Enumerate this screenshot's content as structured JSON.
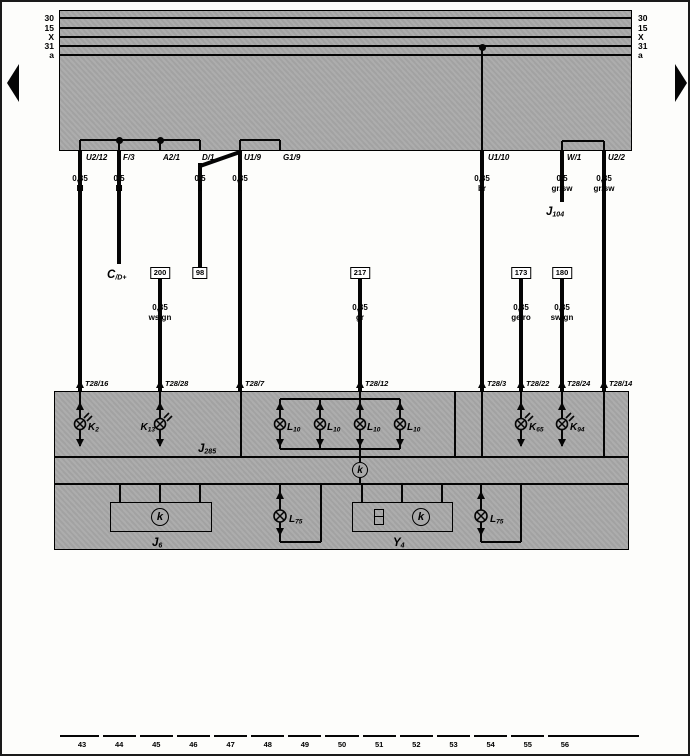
{
  "colors": {
    "band_gray": "#a9a9a9",
    "ink": "#050505",
    "paper": "#fdfdfb"
  },
  "bus": {
    "labels": [
      "30",
      "15",
      "X",
      "31",
      "a"
    ],
    "line_ys": [
      16,
      26,
      35,
      44,
      53
    ],
    "band": {
      "x": 57,
      "y": 8,
      "w": 573,
      "h": 141
    },
    "tap": {
      "x": 480,
      "y": 45
    }
  },
  "pins": {
    "label_y": 151,
    "items": [
      {
        "label": "U2/12",
        "x": 84
      },
      {
        "label": "F/3",
        "x": 121
      },
      {
        "label": "A2/1",
        "x": 161
      },
      {
        "label": "D/1",
        "x": 200
      },
      {
        "label": "U1/9",
        "x": 242
      },
      {
        "label": "G1/9",
        "x": 281
      },
      {
        "label": "U1/10",
        "x": 486
      },
      {
        "label": "W/1",
        "x": 565
      },
      {
        "label": "U2/2",
        "x": 606
      }
    ]
  },
  "brackets": [
    {
      "x1": 78,
      "x2": 198,
      "y": 138,
      "dots": [
        117,
        158
      ]
    },
    {
      "x1": 238,
      "x2": 278,
      "y": 138,
      "dots": []
    },
    {
      "x1": 560,
      "x2": 602,
      "y": 139,
      "dots": []
    }
  ],
  "wires": [
    {
      "x": 78,
      "y1": 149,
      "y2": 389
    },
    {
      "x": 117,
      "y1": 149,
      "y2": 262
    },
    {
      "x": 198,
      "y1": 161,
      "y2": 266
    },
    {
      "x": 158,
      "y1": 276,
      "y2": 389
    },
    {
      "x": 238,
      "y1": 149,
      "y2": 389
    },
    {
      "x": 358,
      "y1": 276,
      "y2": 389
    },
    {
      "x": 480,
      "y1": 149,
      "y2": 389
    },
    {
      "x": 519,
      "y1": 276,
      "y2": 389
    },
    {
      "x": 560,
      "y1": 149,
      "y2": 200
    },
    {
      "x": 560,
      "y1": 276,
      "y2": 389
    },
    {
      "x": 602,
      "y1": 149,
      "y2": 389
    }
  ],
  "diagonal": {
    "x": 198,
    "y": 164,
    "len": 43,
    "angle": -19.3
  },
  "specs": [
    {
      "size": "0,35",
      "color": "bl",
      "x": 78,
      "y": 172
    },
    {
      "size": "0,5",
      "color": "bl",
      "x": 117,
      "y": 172
    },
    {
      "size": "0,5",
      "color": "li",
      "x": 198,
      "y": 172
    },
    {
      "size": "0,35",
      "color": "li",
      "x": 238,
      "y": 172
    },
    {
      "size": "0,35",
      "color": "br",
      "x": 480,
      "y": 172
    },
    {
      "size": "0,5",
      "color": "gr/sw",
      "x": 560,
      "y": 172
    },
    {
      "size": "0,35",
      "color": "gr/sw",
      "x": 602,
      "y": 172
    },
    {
      "size": "0,35",
      "color": "ws/gn",
      "x": 158,
      "y": 301
    },
    {
      "size": "0,35",
      "color": "gr",
      "x": 358,
      "y": 301
    },
    {
      "size": "0,35",
      "color": "ge/ro",
      "x": 519,
      "y": 301
    },
    {
      "size": "0,35",
      "color": "sw/gn",
      "x": 560,
      "y": 301
    }
  ],
  "ref_boxes": {
    "y": 265,
    "items": [
      {
        "label": "200",
        "x": 158
      },
      {
        "label": "98",
        "x": 198
      },
      {
        "label": "217",
        "x": 358
      },
      {
        "label": "173",
        "x": 519
      },
      {
        "label": "180",
        "x": 560
      }
    ]
  },
  "inline_refs": [
    {
      "main": "C",
      "sub": "/D+",
      "x": 105,
      "y": 263
    },
    {
      "main": "J",
      "sub": "104",
      "x": 544,
      "y": 200
    }
  ],
  "terminals": {
    "arrow_y": 378,
    "label_y": 377,
    "items": [
      {
        "label": "T28/16",
        "x": 78
      },
      {
        "label": "T28/28",
        "x": 158
      },
      {
        "label": "T28/7",
        "x": 238
      },
      {
        "label": "T28/12",
        "x": 358
      },
      {
        "label": "T28/3",
        "x": 480
      },
      {
        "label": "T28/22",
        "x": 519
      },
      {
        "label": "T28/24",
        "x": 560
      },
      {
        "label": "T28/14",
        "x": 602
      }
    ]
  },
  "cluster": {
    "rect": {
      "x": 52,
      "y": 389,
      "w": 575,
      "h": 159
    },
    "h_dividers": [
      455,
      482
    ],
    "section_dividers": [
      239,
      453
    ],
    "through_wires": [
      480,
      602
    ],
    "label": {
      "main": "J",
      "sub": "285",
      "x": 196,
      "y": 437
    },
    "k_lamps": [
      {
        "main": "K",
        "sub": "2",
        "x": 78,
        "side": "right"
      },
      {
        "main": "K",
        "sub": "13",
        "x": 158,
        "side": "left"
      },
      {
        "main": "K",
        "sub": "65",
        "x": 519,
        "side": "right"
      },
      {
        "main": "K",
        "sub": "94",
        "x": 560,
        "side": "right"
      }
    ],
    "l10": {
      "main": "L",
      "sub": "10",
      "xs": [
        278,
        318,
        358,
        398
      ],
      "bus_top": 397,
      "bus_bottom": 447,
      "feed_x": 358
    },
    "k_connector": {
      "letter": "k",
      "x": 358,
      "y": 468
    }
  },
  "lower": {
    "box_y": 500,
    "box_h": 30,
    "label_y": 531,
    "boxes": [
      {
        "main": "J",
        "sub": "6",
        "x": 108,
        "w": 102,
        "stubs": [
          118,
          158,
          198
        ],
        "k_x": 158,
        "label_x": 150
      },
      {
        "main": "Y",
        "sub": "4",
        "x": 350,
        "w": 101,
        "stubs": [
          360,
          400,
          440
        ],
        "k_x": 419,
        "clock_x": 372,
        "label_x": 391
      }
    ],
    "lamps": [
      {
        "main": "L",
        "sub": "75",
        "x": 278,
        "loop": 41
      },
      {
        "main": "L",
        "sub": "75",
        "x": 479,
        "loop": 40
      }
    ]
  },
  "ruler": {
    "numbers": [
      "43",
      "44",
      "45",
      "46",
      "47",
      "48",
      "49",
      "50",
      "51",
      "52",
      "53",
      "54",
      "55",
      "56"
    ],
    "y_line": 734,
    "y_text": 738,
    "x1": 58,
    "x2": 637,
    "first_cx": 80,
    "spacing": 37.15
  }
}
